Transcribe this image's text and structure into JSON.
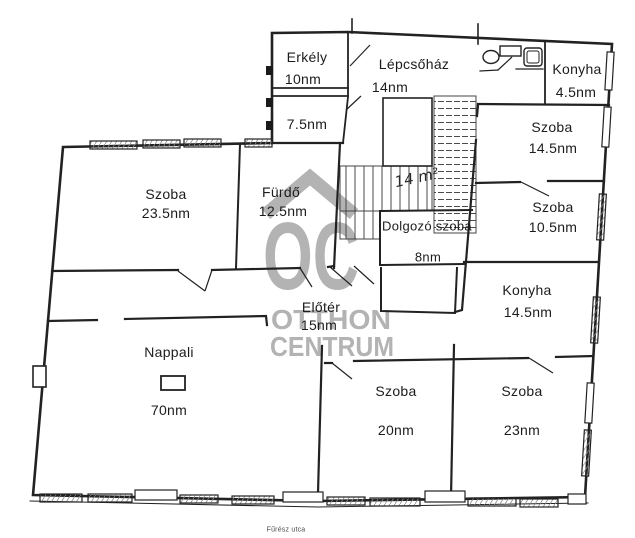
{
  "meta": {
    "street_label": "Fűrész utca",
    "drawing_type": "floor plan"
  },
  "watermark": {
    "logo": "OC",
    "line1": "OTTHON",
    "line2": "CENTRUM",
    "color": "#a6a6a6"
  },
  "annotation": {
    "handwritten_area": "14 m²"
  },
  "colors": {
    "wall": "#222222",
    "background": "#ffffff",
    "text": "#1c1c1c",
    "watermark": "#a6a6a6"
  },
  "rooms": [
    {
      "id": "erkely",
      "name": "Erkély",
      "area": "10nm"
    },
    {
      "id": "lepcsohaz",
      "name": "Lépcsőház",
      "area": "14nm"
    },
    {
      "id": "szoba-7-5",
      "name": "",
      "area": "7.5nm"
    },
    {
      "id": "konyha-kicsi",
      "name": "Konyha",
      "area": "4.5nm"
    },
    {
      "id": "szoba-14-5",
      "name": "Szoba",
      "area": "14.5nm"
    },
    {
      "id": "szoba-10-5",
      "name": "Szoba",
      "area": "10.5nm"
    },
    {
      "id": "konyha-nagy",
      "name": "Konyha",
      "area": "14.5nm"
    },
    {
      "id": "szoba-23-5",
      "name": "Szoba",
      "area": "23.5nm"
    },
    {
      "id": "furdo",
      "name": "Fürdő",
      "area": "12.5nm"
    },
    {
      "id": "dolgozo-szoba",
      "name": "Dolgozó szoba",
      "area": "8nm"
    },
    {
      "id": "eloter",
      "name": "Előtér",
      "area": "15nm"
    },
    {
      "id": "nappali",
      "name": "Nappali",
      "area": "70nm"
    },
    {
      "id": "szoba-20",
      "name": "Szoba",
      "area": "20nm"
    },
    {
      "id": "szoba-23",
      "name": "Szoba",
      "area": "23nm"
    }
  ]
}
